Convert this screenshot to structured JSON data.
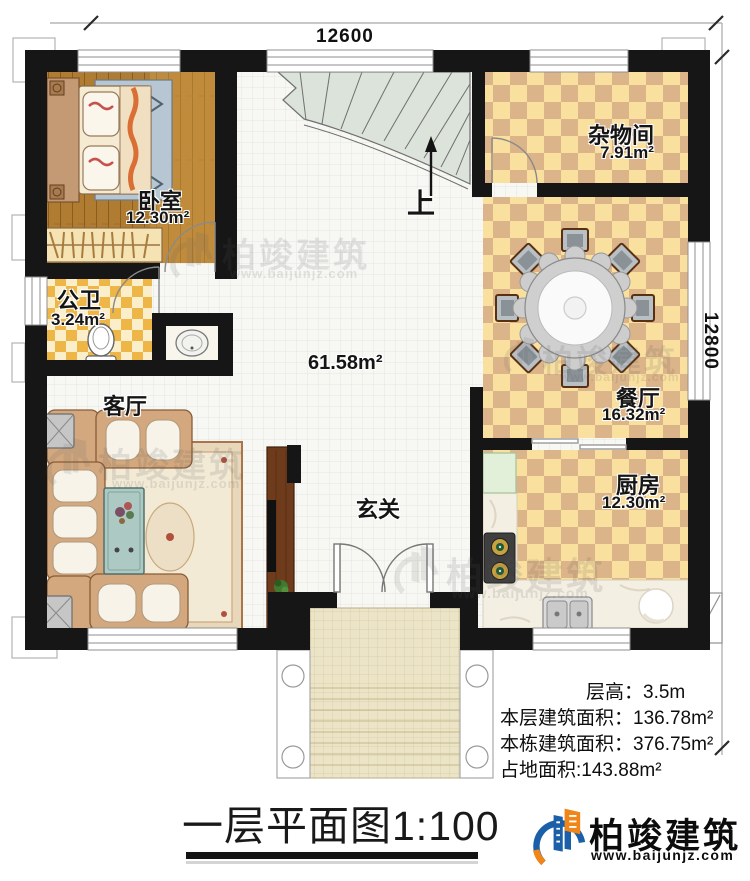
{
  "dimensions": {
    "width_mm": "12600",
    "depth_mm": "12800"
  },
  "stair": {
    "up": "上"
  },
  "hall": {
    "area": "61.58m²"
  },
  "rooms": [
    {
      "name": "卧室",
      "area": "12.30m²"
    },
    {
      "name": "公卫",
      "area": "3.24m²"
    },
    {
      "name": "客厅"
    },
    {
      "name": "杂物间",
      "area": "7.91m²"
    },
    {
      "name": "餐厅",
      "area": "16.32m²"
    },
    {
      "name": "厨房",
      "area": "12.30m²"
    },
    {
      "name": "玄关"
    }
  ],
  "stats": {
    "floor_height": "层高：3.5m",
    "floor_area": "本层建筑面积：136.78m²",
    "total_area": "本栋建筑面积：376.75m²",
    "footprint": "占地面积:143.88m²"
  },
  "title": "一层平面图1:100",
  "brand": {
    "name": "柏竣建筑",
    "website": "www.baijunjz.com"
  },
  "watermark": {
    "name": "柏竣建筑",
    "website": "www.baijunjz.com"
  }
}
